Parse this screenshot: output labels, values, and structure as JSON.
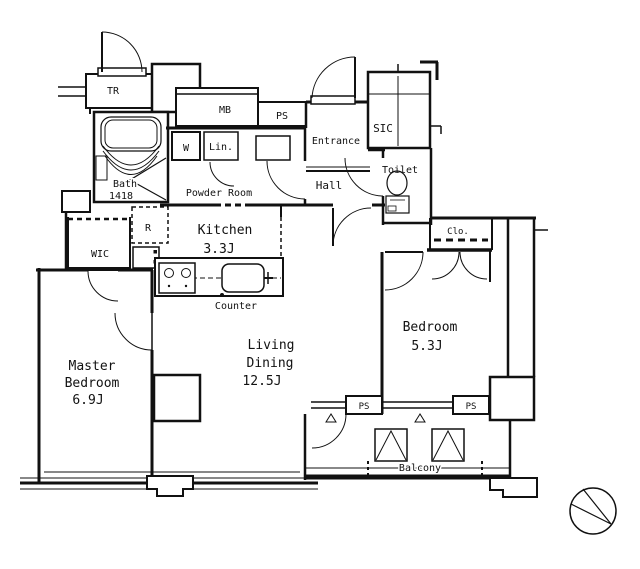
{
  "document": {
    "type": "apartment-floor-plan",
    "background": "#ffffff",
    "line_color": "#111111"
  },
  "labels": {
    "tr": "TR",
    "mb": "MB",
    "ps_top": "PS",
    "entrance": "Entrance",
    "sic": "SIC",
    "toilet": "Toilet",
    "w": "W",
    "lin": "Lin.",
    "bath": "Bath",
    "bath_size": "1418",
    "powder": "Powder Room",
    "hall": "Hall",
    "kitchen": "Kitchen",
    "kitchen_size": "3.3J",
    "r": "R",
    "wic": "WIC",
    "counter": "Counter",
    "master1": "Master",
    "master2": "Bedroom",
    "master_size": "6.9J",
    "living1": "Living",
    "living2": "Dining",
    "living_size": "12.5J",
    "bedroom": "Bedroom",
    "bedroom_size": "5.3J",
    "clo": "Clo.",
    "ps_balcony_left": "PS",
    "ps_balcony_right": "PS",
    "balcony": "Balcony"
  },
  "rooms": [
    {
      "name": "master-bedroom",
      "label": "Master Bedroom",
      "size": "6.9J"
    },
    {
      "name": "living-dining",
      "label": "Living Dining",
      "size": "12.5J"
    },
    {
      "name": "bedroom",
      "label": "Bedroom",
      "size": "5.3J"
    },
    {
      "name": "kitchen",
      "label": "Kitchen",
      "size": "3.3J"
    },
    {
      "name": "bath",
      "label": "Bath",
      "size": "1418"
    },
    {
      "name": "powder-room",
      "label": "Powder Room"
    },
    {
      "name": "toilet",
      "label": "Toilet"
    },
    {
      "name": "entrance",
      "label": "Entrance"
    },
    {
      "name": "hall",
      "label": "Hall"
    },
    {
      "name": "sic",
      "label": "SIC"
    },
    {
      "name": "wic",
      "label": "WIC"
    },
    {
      "name": "closet",
      "label": "Clo."
    },
    {
      "name": "balcony",
      "label": "Balcony"
    },
    {
      "name": "trunk-room",
      "label": "TR"
    },
    {
      "name": "meter-box",
      "label": "MB"
    },
    {
      "name": "pipe-space",
      "label": "PS"
    }
  ]
}
